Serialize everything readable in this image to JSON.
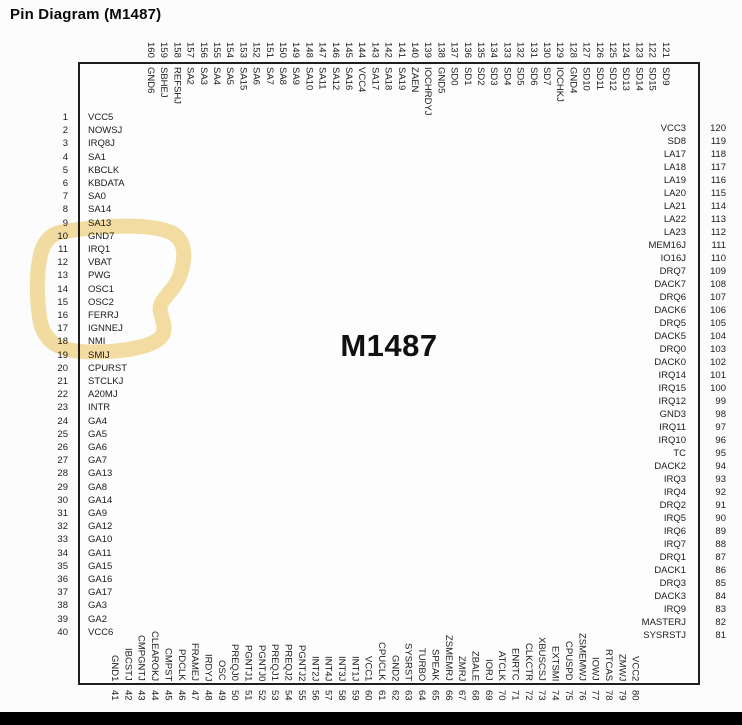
{
  "title": "Pin Diagram (M1487)",
  "chip": {
    "name": "M1487"
  },
  "colors": {
    "highlight": "#e9bd45",
    "ink": "#1c1c1c",
    "bottom_bar": "#000000"
  },
  "annotation": {
    "type": "hand-drawn highlighter loop around pins 9-19"
  },
  "pins": {
    "left": [
      {
        "num": "1",
        "label": "VCC5"
      },
      {
        "num": "2",
        "label": "NOWSJ"
      },
      {
        "num": "3",
        "label": "IRQ8J"
      },
      {
        "num": "4",
        "label": "SA1"
      },
      {
        "num": "5",
        "label": "KBCLK"
      },
      {
        "num": "6",
        "label": "KBDATA"
      },
      {
        "num": "7",
        "label": "SA0"
      },
      {
        "num": "8",
        "label": "SA14"
      },
      {
        "num": "9",
        "label": "SA13"
      },
      {
        "num": "10",
        "label": "GND7"
      },
      {
        "num": "11",
        "label": "IRQ1"
      },
      {
        "num": "12",
        "label": "VBAT"
      },
      {
        "num": "13",
        "label": "PWG"
      },
      {
        "num": "14",
        "label": "OSC1"
      },
      {
        "num": "15",
        "label": "OSC2"
      },
      {
        "num": "16",
        "label": "FERRJ"
      },
      {
        "num": "17",
        "label": "IGNNEJ"
      },
      {
        "num": "18",
        "label": "NMI"
      },
      {
        "num": "19",
        "label": "SMIJ"
      },
      {
        "num": "20",
        "label": "CPURST"
      },
      {
        "num": "21",
        "label": "STCLKJ"
      },
      {
        "num": "22",
        "label": "A20MJ"
      },
      {
        "num": "23",
        "label": "INTR"
      },
      {
        "num": "24",
        "label": "GA4"
      },
      {
        "num": "25",
        "label": "GA5"
      },
      {
        "num": "26",
        "label": "GA6"
      },
      {
        "num": "27",
        "label": "GA7"
      },
      {
        "num": "28",
        "label": "GA13"
      },
      {
        "num": "29",
        "label": "GA8"
      },
      {
        "num": "30",
        "label": "GA14"
      },
      {
        "num": "31",
        "label": "GA9"
      },
      {
        "num": "32",
        "label": "GA12"
      },
      {
        "num": "33",
        "label": "GA10"
      },
      {
        "num": "34",
        "label": "GA11"
      },
      {
        "num": "35",
        "label": "GA15"
      },
      {
        "num": "36",
        "label": "GA16"
      },
      {
        "num": "37",
        "label": "GA17"
      },
      {
        "num": "38",
        "label": "GA3"
      },
      {
        "num": "39",
        "label": "GA2"
      },
      {
        "num": "40",
        "label": "VCC6"
      }
    ],
    "bottom": [
      {
        "num": "41",
        "label": "GND1"
      },
      {
        "num": "42",
        "label": "IBCSTJ"
      },
      {
        "num": "43",
        "label": "CMPGNTJ"
      },
      {
        "num": "44",
        "label": "CLEAROKJ"
      },
      {
        "num": "45",
        "label": "CMPST"
      },
      {
        "num": "46",
        "label": "PDCLK"
      },
      {
        "num": "47",
        "label": "FRAMEJ"
      },
      {
        "num": "48",
        "label": "IRDYJ"
      },
      {
        "num": "49",
        "label": "OSC"
      },
      {
        "num": "50",
        "label": "PREQJ0"
      },
      {
        "num": "51",
        "label": "PGNTJ1"
      },
      {
        "num": "52",
        "label": "PGNTJ0"
      },
      {
        "num": "53",
        "label": "PREQJ1"
      },
      {
        "num": "54",
        "label": "PREQJ2"
      },
      {
        "num": "55",
        "label": "PGNTJ2"
      },
      {
        "num": "56",
        "label": "INT2J"
      },
      {
        "num": "57",
        "label": "INT4J"
      },
      {
        "num": "58",
        "label": "INT3J"
      },
      {
        "num": "59",
        "label": "INT1J"
      },
      {
        "num": "60",
        "label": "VCC1"
      },
      {
        "num": "61",
        "label": "CPUCLK"
      },
      {
        "num": "62",
        "label": "GND2"
      },
      {
        "num": "63",
        "label": "SYSRST"
      },
      {
        "num": "64",
        "label": "TURBO"
      },
      {
        "num": "65",
        "label": "SPEAK"
      },
      {
        "num": "66",
        "label": "ZSMEMRJ"
      },
      {
        "num": "67",
        "label": "ZMRJ"
      },
      {
        "num": "68",
        "label": "ZBALE"
      },
      {
        "num": "69",
        "label": "IORJ"
      },
      {
        "num": "70",
        "label": "ATCLK"
      },
      {
        "num": "71",
        "label": "ENRTC"
      },
      {
        "num": "72",
        "label": "CLKCTR"
      },
      {
        "num": "73",
        "label": "XBUSCSJ"
      },
      {
        "num": "74",
        "label": "EXTSMI"
      },
      {
        "num": "75",
        "label": "CPUSPD"
      },
      {
        "num": "76",
        "label": "ZSMEMWJ"
      },
      {
        "num": "77",
        "label": "IOWJ"
      },
      {
        "num": "78",
        "label": "RTCAS"
      },
      {
        "num": "79",
        "label": "ZMWJ"
      },
      {
        "num": "80",
        "label": "VCC2"
      }
    ],
    "right": [
      {
        "num": "120",
        "label": "VCC3"
      },
      {
        "num": "119",
        "label": "SD8"
      },
      {
        "num": "118",
        "label": "LA17"
      },
      {
        "num": "117",
        "label": "LA18"
      },
      {
        "num": "116",
        "label": "LA19"
      },
      {
        "num": "115",
        "label": "LA20"
      },
      {
        "num": "114",
        "label": "LA21"
      },
      {
        "num": "113",
        "label": "LA22"
      },
      {
        "num": "112",
        "label": "LA23"
      },
      {
        "num": "111",
        "label": "MEM16J"
      },
      {
        "num": "110",
        "label": "IO16J"
      },
      {
        "num": "109",
        "label": "DRQ7"
      },
      {
        "num": "108",
        "label": "DACK7"
      },
      {
        "num": "107",
        "label": "DRQ6"
      },
      {
        "num": "106",
        "label": "DACK6"
      },
      {
        "num": "105",
        "label": "DRQ5"
      },
      {
        "num": "104",
        "label": "DACK5"
      },
      {
        "num": "103",
        "label": "DRQ0"
      },
      {
        "num": "102",
        "label": "DACK0"
      },
      {
        "num": "101",
        "label": "IRQ14"
      },
      {
        "num": "100",
        "label": "IRQ15"
      },
      {
        "num": "99",
        "label": "IRQ12"
      },
      {
        "num": "98",
        "label": "GND3"
      },
      {
        "num": "97",
        "label": "IRQ11"
      },
      {
        "num": "96",
        "label": "IRQ10"
      },
      {
        "num": "95",
        "label": "TC"
      },
      {
        "num": "94",
        "label": "DACK2"
      },
      {
        "num": "93",
        "label": "IRQ3"
      },
      {
        "num": "92",
        "label": "IRQ4"
      },
      {
        "num": "91",
        "label": "DRQ2"
      },
      {
        "num": "90",
        "label": "IRQ5"
      },
      {
        "num": "89",
        "label": "IRQ6"
      },
      {
        "num": "88",
        "label": "IRQ7"
      },
      {
        "num": "87",
        "label": "DRQ1"
      },
      {
        "num": "86",
        "label": "DACK1"
      },
      {
        "num": "85",
        "label": "DRQ3"
      },
      {
        "num": "84",
        "label": "DACK3"
      },
      {
        "num": "83",
        "label": "IRQ9"
      },
      {
        "num": "82",
        "label": "MASTERJ"
      },
      {
        "num": "81",
        "label": "SYSRSTJ"
      }
    ],
    "top": [
      {
        "num": "160",
        "label": "GND6"
      },
      {
        "num": "159",
        "label": "SBHEJ"
      },
      {
        "num": "158",
        "label": "REFSHJ"
      },
      {
        "num": "157",
        "label": "SA2"
      },
      {
        "num": "156",
        "label": "SA3"
      },
      {
        "num": "155",
        "label": "SA4"
      },
      {
        "num": "154",
        "label": "SA5"
      },
      {
        "num": "153",
        "label": "SA15"
      },
      {
        "num": "152",
        "label": "SA6"
      },
      {
        "num": "151",
        "label": "SA7"
      },
      {
        "num": "150",
        "label": "SA8"
      },
      {
        "num": "149",
        "label": "SA9"
      },
      {
        "num": "148",
        "label": "SA10"
      },
      {
        "num": "147",
        "label": "SA11"
      },
      {
        "num": "146",
        "label": "SA12"
      },
      {
        "num": "145",
        "label": "SA16"
      },
      {
        "num": "144",
        "label": "VCC4"
      },
      {
        "num": "143",
        "label": "SA17"
      },
      {
        "num": "142",
        "label": "SA18"
      },
      {
        "num": "141",
        "label": "SA19"
      },
      {
        "num": "140",
        "label": "ZAEN"
      },
      {
        "num": "139",
        "label": "IOCHRDYJ"
      },
      {
        "num": "138",
        "label": "GND5"
      },
      {
        "num": "137",
        "label": "SD0"
      },
      {
        "num": "136",
        "label": "SD1"
      },
      {
        "num": "135",
        "label": "SD2"
      },
      {
        "num": "134",
        "label": "SD3"
      },
      {
        "num": "133",
        "label": "SD4"
      },
      {
        "num": "132",
        "label": "SD5"
      },
      {
        "num": "131",
        "label": "SD6"
      },
      {
        "num": "130",
        "label": "SD7"
      },
      {
        "num": "129",
        "label": "IOCHKJ"
      },
      {
        "num": "128",
        "label": "GND4"
      },
      {
        "num": "127",
        "label": "SD10"
      },
      {
        "num": "126",
        "label": "SD11"
      },
      {
        "num": "125",
        "label": "SD12"
      },
      {
        "num": "124",
        "label": "SD13"
      },
      {
        "num": "123",
        "label": "SD14"
      },
      {
        "num": "122",
        "label": "SD15"
      },
      {
        "num": "121",
        "label": "SD9"
      }
    ]
  }
}
